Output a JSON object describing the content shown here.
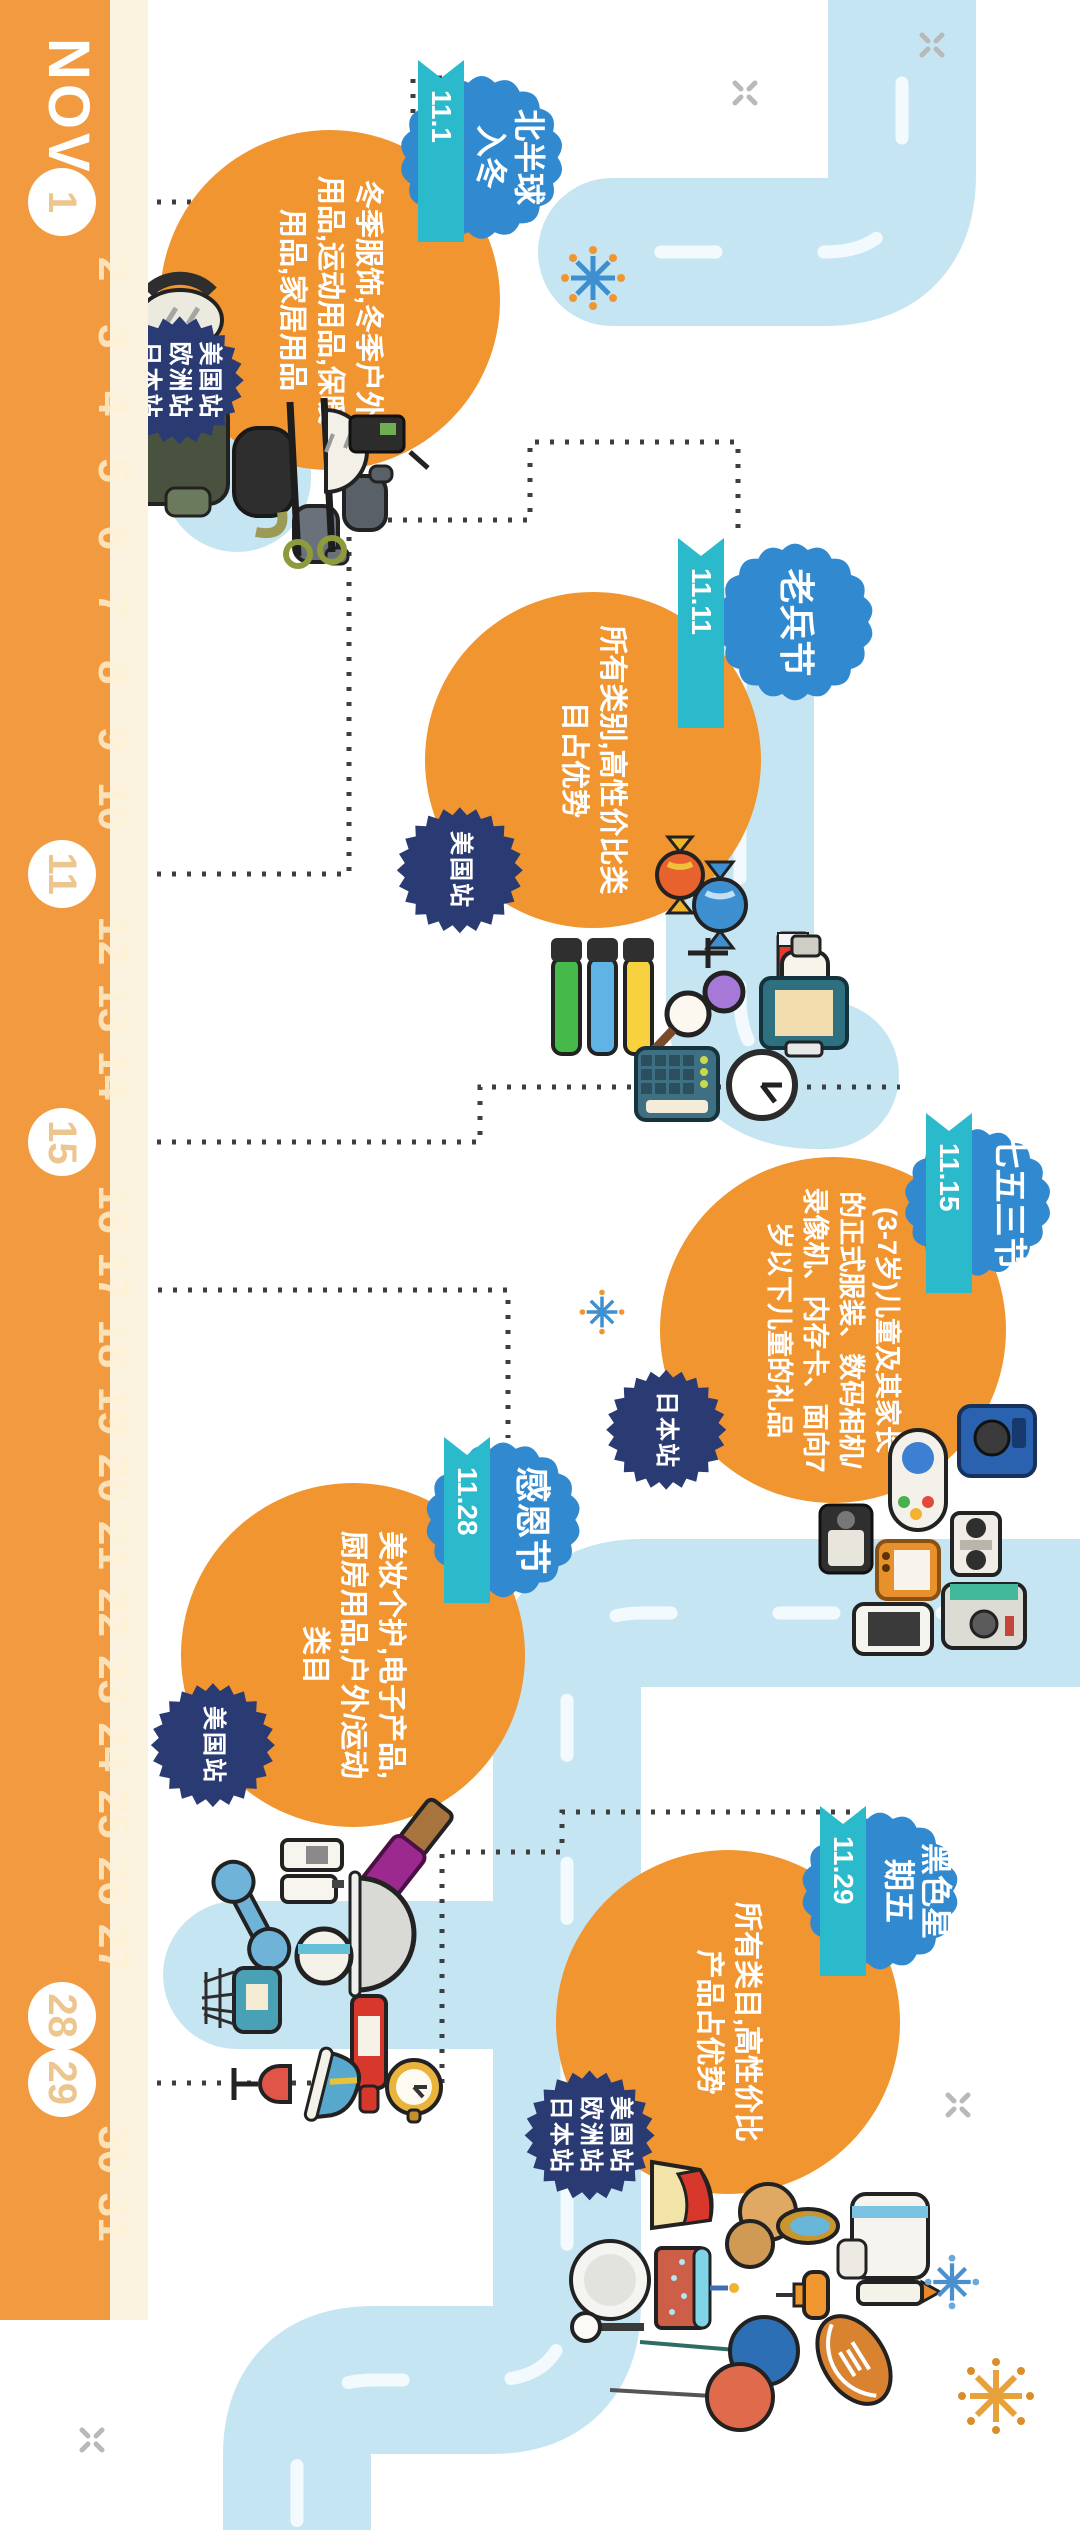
{
  "calendar": {
    "month": "NOV",
    "total_days": 31,
    "highlighted_days": [
      1,
      11,
      15,
      28,
      29
    ]
  },
  "events": [
    {
      "name": "北半球入冬",
      "name_lines": [
        "北半球",
        "入冬"
      ],
      "date": "11.1",
      "desc_lines": [
        "冬季服饰,冬季户外",
        "用品,运动用品,保暖",
        "用品,家居用品"
      ],
      "stations": [
        "美国站",
        "欧洲站",
        "日本站"
      ],
      "icons": [
        "winter-jacket",
        "headphones",
        "ski-goggles",
        "gloves",
        "ski-poles",
        "helmet",
        "walkie-talkie",
        "ice-skate"
      ]
    },
    {
      "name": "老兵节",
      "name_lines": [
        "老兵节"
      ],
      "date": "11.11",
      "desc_lines": [
        "所有类别,高性价比类",
        "目占优势"
      ],
      "stations": [
        "美国站"
      ],
      "cream_label": "CREAM",
      "icons": [
        "candy",
        "highlighter-markers",
        "magnifier",
        "cream-tube",
        "lotion-bottle",
        "clipboard",
        "calculator",
        "alarm-clock"
      ]
    },
    {
      "name": "七五三节",
      "name_lines": [
        "七五三节"
      ],
      "date": "11.15",
      "desc_lines": [
        "(3-7岁)儿童及其家长",
        "的正式服装、数码相机/",
        "录像机、内存卡、面向7",
        "岁以下儿童的礼品"
      ],
      "stations": [
        "日本站"
      ],
      "icons": [
        "game-controller",
        "digital-camera",
        "video-camera",
        "handheld-console",
        "boombox",
        "smartphone",
        "instant-camera"
      ]
    },
    {
      "name": "感恩节",
      "name_lines": [
        "感恩节"
      ],
      "date": "11.28",
      "desc_lines": [
        "美妆个护,电子产品,",
        "厨房用品,户外/运动",
        "类目"
      ],
      "stations": [
        "美国站"
      ],
      "icons": [
        "makeup-brush",
        "dumbbell",
        "cosmetic-bottles",
        "mixing-bowl",
        "hair-dryer",
        "basketball-hoop",
        "wine-bottle",
        "wine-glass",
        "sneaker",
        "pocket-watch"
      ]
    },
    {
      "name": "黑色星期五",
      "name_lines": [
        "黑色星",
        "期五"
      ],
      "date": "11.29",
      "desc_lines": [
        "所有类目,高性价比",
        "产品占优势"
      ],
      "stations": [
        "美国站",
        "欧洲站",
        "日本站"
      ],
      "icons": [
        "cake-slice",
        "plate",
        "birthday-cake",
        "pie",
        "hand-mirror",
        "spoon",
        "balloons",
        "american-football",
        "push-pin",
        "pen",
        "towel"
      ]
    }
  ],
  "colors": {
    "band_orange": "#F19A40",
    "circle_orange": "#F0952F",
    "ribbon_teal": "#2ABACC",
    "badge_blue": "#3189CF",
    "badge_navy": "#2A3A72",
    "road_blue": "#C6E5F2",
    "road_dash": "#F2FAFD",
    "connector": "#3E3E3E"
  }
}
